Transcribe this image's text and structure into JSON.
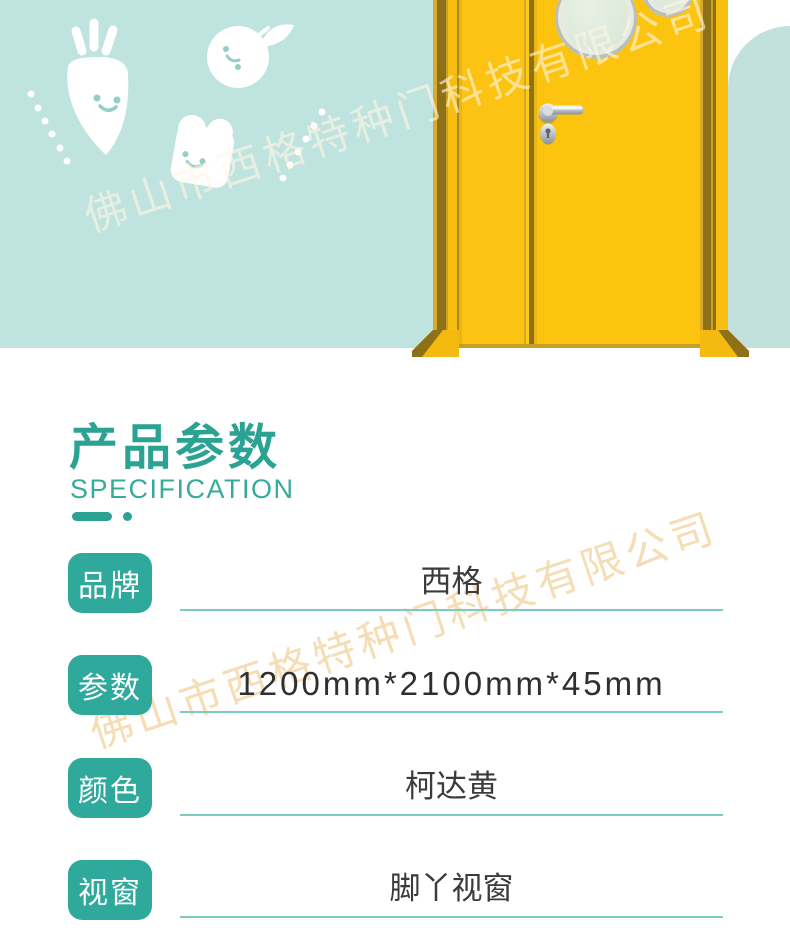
{
  "watermark": {
    "text": "佛山市西格特种门科技有限公司"
  },
  "hero": {
    "background_color": "#bfe3df",
    "door_color": "#fdc40f",
    "illustration_icons": [
      "carrot-icon",
      "tomato-icon",
      "toast-icon",
      "dotted-line-left",
      "dotted-line-right"
    ],
    "door_features": [
      "porthole-window",
      "door-handle",
      "door-lock"
    ]
  },
  "section_header": {
    "title": "产品参数",
    "subtitle": "SPECIFICATION"
  },
  "spec_table": {
    "rows": [
      {
        "label": "品牌",
        "value": "西格"
      },
      {
        "label": "参数",
        "value": "1200mm*2100mm*45mm"
      },
      {
        "label": "颜色",
        "value": "柯达黄"
      },
      {
        "label": "视窗",
        "value": "脚丫视窗"
      }
    ]
  },
  "colors": {
    "accent_teal": "#2ba392",
    "badge_teal": "#2ea99b",
    "underline_teal": "#7fcac1",
    "banner_mint": "#bfe3df",
    "door_yellow": "#fdc40f",
    "watermark_cream": "#f3d5a3",
    "value_text": "#3b3b3b"
  }
}
